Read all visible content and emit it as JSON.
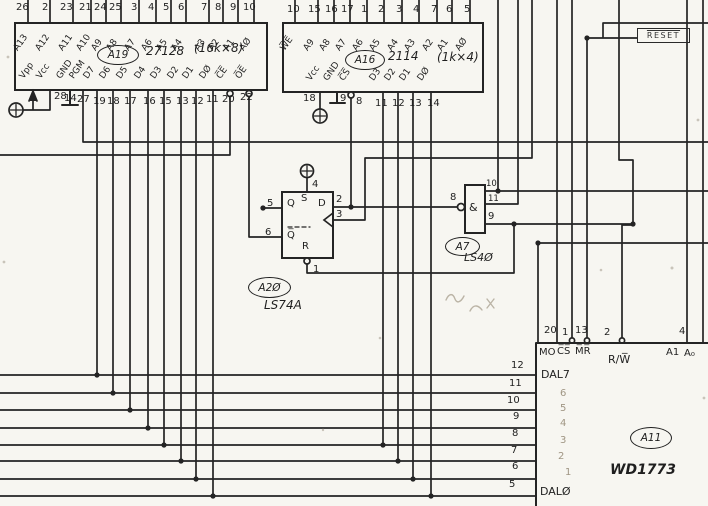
{
  "colors": {
    "ink": "#242424",
    "paper": "#f7f6f1",
    "pencil": "#a89f8e"
  },
  "eprom": {
    "ref": "A19",
    "part": "27128",
    "capacity": "(16k×8)",
    "top": [
      {
        "n": "26",
        "l": "A13"
      },
      {
        "n": "2",
        "l": "A12"
      },
      {
        "n": "23",
        "l": "A11"
      },
      {
        "n": "21",
        "l": "A10"
      },
      {
        "n": "24",
        "l": "A9"
      },
      {
        "n": "25",
        "l": "A8"
      },
      {
        "n": "3",
        "l": "A7"
      },
      {
        "n": "4",
        "l": "A6"
      },
      {
        "n": "5",
        "l": "A5"
      },
      {
        "n": "6",
        "l": "A4"
      },
      {
        "n": "7",
        "l": "A3"
      },
      {
        "n": "8",
        "l": "A2"
      },
      {
        "n": "9",
        "l": "A1"
      },
      {
        "n": "10",
        "l": "AØ"
      }
    ],
    "bottom": [
      {
        "n": "",
        "l": "Vpp"
      },
      {
        "n": "28",
        "l": "Vcc"
      },
      {
        "n": "14",
        "l": "GND"
      },
      {
        "n": "27",
        "l": "PGM"
      },
      {
        "n": "19",
        "l": "D7"
      },
      {
        "n": "18",
        "l": "D6"
      },
      {
        "n": "17",
        "l": "D5"
      },
      {
        "n": "16",
        "l": "D4"
      },
      {
        "n": "15",
        "l": "D3"
      },
      {
        "n": "13",
        "l": "D2"
      },
      {
        "n": "12",
        "l": "D1"
      },
      {
        "n": "11",
        "l": "DØ"
      },
      {
        "n": "20",
        "l": "C̅E̅"
      },
      {
        "n": "22",
        "l": "O̅E̅"
      }
    ]
  },
  "ram": {
    "ref": "A16",
    "part": "2114",
    "capacity": "(1k×4)",
    "top": [
      {
        "n": "10",
        "l": "W̅E̅"
      },
      {
        "n": "15",
        "l": "A9"
      },
      {
        "n": "16",
        "l": "A8"
      },
      {
        "n": "17",
        "l": "A7"
      },
      {
        "n": "1",
        "l": "A6"
      },
      {
        "n": "2",
        "l": "A5"
      },
      {
        "n": "3",
        "l": "A4"
      },
      {
        "n": "4",
        "l": "A3"
      },
      {
        "n": "7",
        "l": "A2"
      },
      {
        "n": "6",
        "l": "A1"
      },
      {
        "n": "5",
        "l": "AØ"
      }
    ],
    "bottom": [
      {
        "n": "18",
        "l": "Vcc"
      },
      {
        "n": "9",
        "l": "GND"
      },
      {
        "n": "8",
        "l": "C̅S̅"
      },
      {
        "n": "11",
        "l": "D3"
      },
      {
        "n": "12",
        "l": "D2"
      },
      {
        "n": "13",
        "l": "D1"
      },
      {
        "n": "14",
        "l": "DØ"
      }
    ]
  },
  "ff": {
    "ref": "A2Ø",
    "part": "LS74A",
    "pin_q": "5",
    "pin_qb": "6",
    "pin_d": "2",
    "pin_clk": "3",
    "pin_set": "4",
    "pin_rst": "1",
    "lbl_q": "Q",
    "lbl_qb": "Q̅",
    "lbl_d": "D",
    "lbl_s": "S",
    "lbl_r": "R"
  },
  "nand": {
    "ref": "A7",
    "part": "LS4Ø",
    "gate": "&",
    "pin_out": "8",
    "pin_in1": "10",
    "pin_in2": "11",
    "pin_in3": "9"
  },
  "fdc": {
    "ref": "A11",
    "part": "WD1773",
    "top": [
      {
        "n": "20",
        "l": "MO"
      },
      {
        "n": "1",
        "l": "C̅S̅"
      },
      {
        "n": "13",
        "l": "M̅R̅"
      },
      {
        "n": "2",
        "l": "R/W̅"
      },
      {
        "n": "4",
        "l": "A1"
      },
      {
        "n": "",
        "l": "A₀"
      }
    ],
    "left": [
      {
        "n": "12",
        "l": "DAL7"
      },
      {
        "n": "11",
        "l": "6"
      },
      {
        "n": "10",
        "l": "5"
      },
      {
        "n": "9",
        "l": "4"
      },
      {
        "n": "8",
        "l": "3"
      },
      {
        "n": "7",
        "l": "2"
      },
      {
        "n": "6",
        "l": "1"
      },
      {
        "n": "5",
        "l": "DALØ"
      }
    ]
  },
  "reset": {
    "label": "RESET"
  }
}
